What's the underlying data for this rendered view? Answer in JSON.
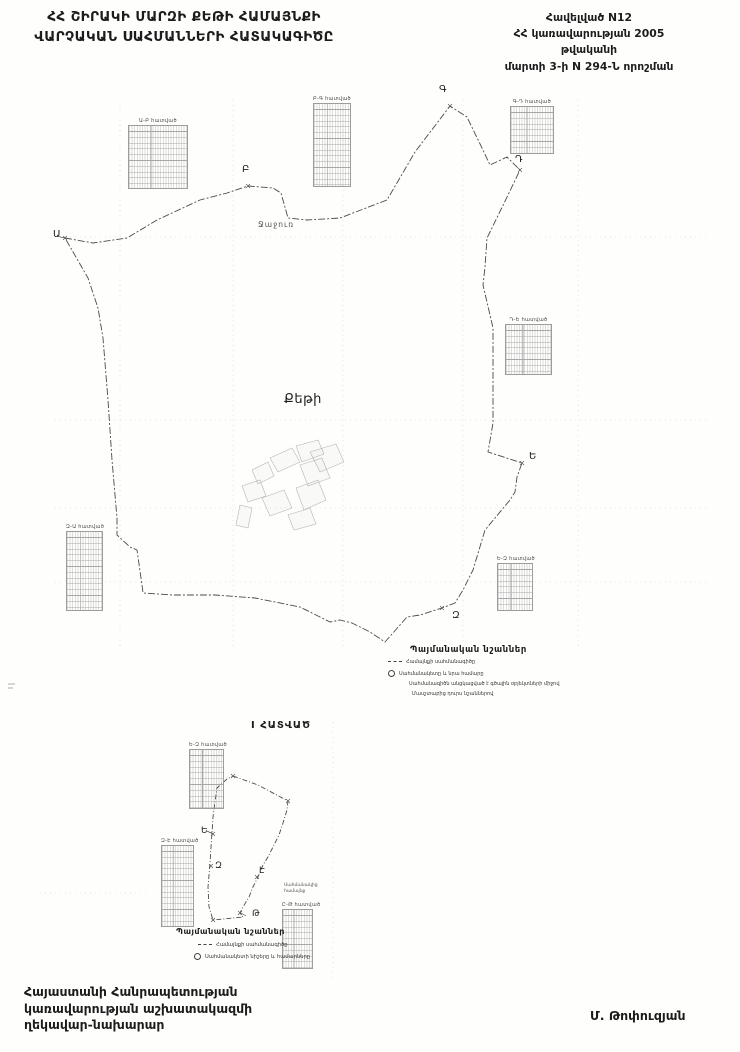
{
  "header": {
    "title_lines": [
      "ՀՀ ՇԻՐԱԿԻ ՄԱՐԶԻ ՔԵԹԻ ՀԱՄԱՅՆՔԻ",
      "ՎԱՐՉԱԿԱՆ ՍԱՀՄԱՆՆԵՐԻ ՀԱՏԱԿԱԳԻԾԸ"
    ],
    "annex_lines": [
      "Հավելված N12",
      "ՀՀ կառավարության 2005 թվականի",
      "մարտի 3-ի N 294-Ն որոշման"
    ]
  },
  "colors": {
    "ink": "#1c1c1c",
    "boundary": "#4a4a4a",
    "grid": "#cccccc",
    "parcel": "#b5b5b5"
  },
  "main_map": {
    "community_label": "Քեթի",
    "neighbor_label": "Ջաջուռ",
    "boundary_svg_points": "65,238 93,243 127,238 157,220 200,200 227,193 248,186 273,188 281,193 288,218 307,220 340,218 387,200 415,152 450,106 467,117 482,148 490,165 507,157 520,170 508,195 490,232 487,238 485,267 483,285 490,315 493,328 493,423 488,452 522,463 517,477 515,492 510,500 485,530 473,570 463,590 455,603 442,608 420,615 407,617 385,642 370,632 352,623 340,620 330,622 300,607 255,598 215,595 172,595 143,593 142,585 137,550 130,547 117,535 117,518 112,460 108,400 103,338 98,308 88,278",
    "points": [
      {
        "label": "Ա",
        "x": 53,
        "y": 229
      },
      {
        "label": "Բ",
        "x": 242,
        "y": 164
      },
      {
        "label": "Գ",
        "x": 439,
        "y": 84
      },
      {
        "label": "Դ",
        "x": 515,
        "y": 154
      },
      {
        "label": "Ե",
        "x": 529,
        "y": 451
      },
      {
        "label": "Զ",
        "x": 452,
        "y": 610
      }
    ],
    "marks": [
      "65,238",
      "248,186",
      "450,106",
      "520,170",
      "522,463",
      "442,608"
    ],
    "settlement_shapes": [
      "252,470 268,462 274,476 258,484",
      "270,458 292,448 300,462 278,472",
      "296,446 318,440 324,454 302,462",
      "300,465 322,458 330,478 308,486",
      "242,486 260,480 266,496 248,502",
      "262,498 284,490 292,508 270,516",
      "296,488 318,480 326,500 304,510",
      "310,452 336,444 344,462 320,472",
      "240,505 236,525 248,528 252,508",
      "288,515 310,508 316,524 294,530"
    ],
    "tables": [
      {
        "label": "Ա-Բ հատված",
        "x": 128,
        "y": 118,
        "w": 58,
        "h": 62
      },
      {
        "label": "Բ-Գ հատված",
        "x": 313,
        "y": 96,
        "w": 36,
        "h": 82
      },
      {
        "label": "Գ-Դ հատված",
        "x": 510,
        "y": 99,
        "w": 42,
        "h": 46
      },
      {
        "label": "Դ-Ե հատված",
        "x": 505,
        "y": 317,
        "w": 45,
        "h": 49
      },
      {
        "label": "Ե-Զ հատված",
        "x": 497,
        "y": 556,
        "w": 34,
        "h": 46
      },
      {
        "label": "Զ-Ա հատված",
        "x": 66,
        "y": 524,
        "w": 35,
        "h": 78
      }
    ],
    "legend": {
      "title": "Պայմանական նշաններ",
      "items": [
        {
          "symbol": "line",
          "text": "Համայնքի սահմանագիծը"
        },
        {
          "symbol": "circle",
          "text": "Սահմանակետը և նրա համարը"
        },
        {
          "symbol": "none",
          "text": "Սահմանագիծն անցկացված է գծային օբյեկտների միջով"
        },
        {
          "symbol": "none",
          "text": "Մասշտաբից դուրս նշաններով"
        }
      ]
    }
  },
  "section_map": {
    "title": "I ՀԱՏՎԱԾ",
    "boundary_svg_points": "233,776 258,785 288,801 287,810 283,823 279,835 273,847 268,857 263,865 258,877 253,887 249,897 243,907 240,913 243,917 213,920 209,907 208,887 210,863 211,847 212,833 213,817 215,802 217,788 227,779",
    "points": [
      {
        "label": "Ե",
        "x": 201,
        "y": 826
      },
      {
        "label": "Զ",
        "x": 215,
        "y": 861
      },
      {
        "label": "Է",
        "x": 259,
        "y": 866
      },
      {
        "label": "Թ",
        "x": 252,
        "y": 909
      }
    ],
    "marks": [
      "233,776",
      "288,801",
      "213,834",
      "211,866",
      "257,877",
      "240,913",
      "213,920"
    ],
    "tables": [
      {
        "label": "Ե-Զ հատված",
        "x": 189,
        "y": 742,
        "w": 33,
        "h": 58
      },
      {
        "label": "Զ-Է հատված",
        "x": 161,
        "y": 838,
        "w": 31,
        "h": 80
      },
      {
        "label": "Ը-Թ հատված",
        "x": 282,
        "y": 902,
        "w": 29,
        "h": 58
      }
    ],
    "side_label_lines": [
      "Սահմանակից",
      "համայնք"
    ],
    "legend": {
      "title": "Պայմանական նշաններ",
      "items": [
        {
          "symbol": "line",
          "text": "Համայնքի սահմանագիծը"
        },
        {
          "symbol": "circle",
          "text": "Սահմանակետի նիշերը և համարները"
        }
      ]
    }
  },
  "footer": {
    "left_lines": [
      "Հայաստանի Հանրապետության",
      "կառավարության աշխատակազմի",
      "ղեկավար-նախարար"
    ],
    "signature": "Մ. Թոփուզյան"
  }
}
